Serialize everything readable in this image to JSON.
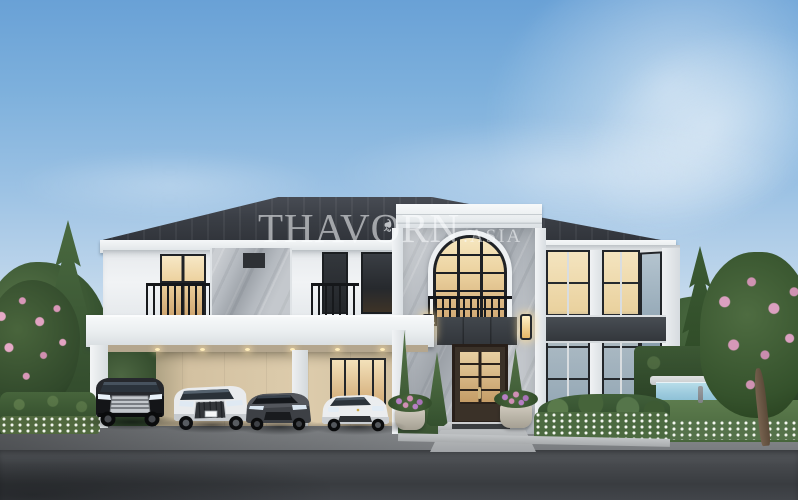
{
  "scene": {
    "type": "exterior-architectural-rendering",
    "subject": "Two-storey luxury villa with marble entrance tower, carport with four cars, garden and swimming pool",
    "watermark": {
      "main": "THAVORN",
      "suffix": ".ASIA",
      "ornament_glyph": "❧"
    },
    "palette": {
      "sky_top": "#69A1D6",
      "sky_horizon": "#EDF3F6",
      "roof": "#363A41",
      "wall_white": "#EFF1F3",
      "marble_grey": "#B4B9BF",
      "warm_window_light": "#F2DFB4",
      "door_brown": "#3A3128",
      "carport_wall_beige": "#D8C7A7",
      "railing_black": "#17191C",
      "hedge_green": "#3E5A37",
      "pink_blossom": "#DC99B8",
      "pool_water": "#9FCBDF",
      "asphalt_road": "#3E4145",
      "driveway": "#85888C"
    },
    "objects": {
      "cars": [
        "black luxury van",
        "white suv",
        "grey sedan",
        "white sports sedan"
      ],
      "features": [
        "dark hip roof",
        "arched marble tower window",
        "wrought-iron balconies",
        "carport with recessed downlights",
        "double-height corner glazing",
        "swimming pool",
        "topiary cones and flower planters",
        "pine and blossom trees"
      ]
    }
  }
}
